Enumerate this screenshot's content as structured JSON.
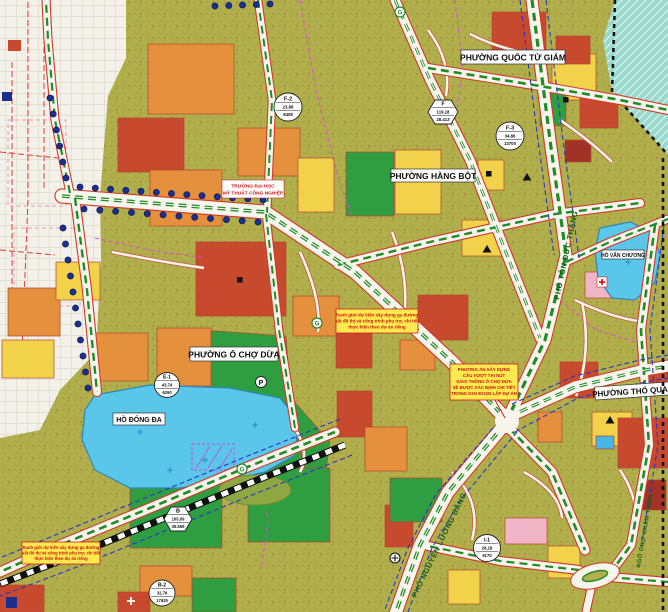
{
  "map": {
    "wards": [
      "PHƯỜNG QUỐC TỬ GIÁM",
      "PHƯỜNG HÀNG BỘT",
      "PHƯỜNG Ô CHỢ DỪA",
      "PHƯỜNG THỔ QUAN"
    ],
    "lakes": [
      "HỒ ĐỐNG ĐA",
      "HỒ VĂN CHƯƠNG"
    ],
    "streets": [
      "PHỐ TÔN ĐỨC THẮNG",
      "PHỐ NGUYỄN LƯƠNG BẰNG",
      "NGÕ CHỢ KHÂM THIÊN"
    ],
    "poi": {
      "university_line1": "TRƯỜNG ĐẠI HỌC",
      "university_line2": "MỸ THUẬT CÔNG NGHIỆP"
    },
    "notes": {
      "metro_station": [
        "Ranh giới dự kiến xây dựng ga đường",
        "sắt đô thị và công trình phụ trợ, chi tiết",
        "thực hiện theo dự án riêng"
      ],
      "overpass": [
        "PHƯƠNG ÁN XÂY DỰNG",
        "CẦU VƯỢT TẠI NÚT",
        "GIAO THÔNG Ô CHỢ DỪA",
        "SẼ ĐƯỢC XÁC ĐỊNH CHI TIẾT",
        "TRONG GIAI ĐOẠN LẬP DỰ ÁN"
      ]
    },
    "parcel_markers": [
      {
        "id": "F-2",
        "area": "23,88",
        "population": "8408"
      },
      {
        "id": "F",
        "area": "119,18",
        "population": "28.413"
      },
      {
        "id": "F-3",
        "area": "34,86",
        "population": "13700"
      },
      {
        "id": "E-1",
        "area": "43,74",
        "population": "6290"
      },
      {
        "id": "B",
        "area": "105,09",
        "population": "35.559"
      },
      {
        "id": "B-2",
        "area": "32,76",
        "population": "17625"
      },
      {
        "id": "I-1",
        "area": "26,18",
        "population": "9170"
      }
    ],
    "symbols": {
      "parking": "P",
      "station": "G"
    },
    "colors": {
      "olive_residential": "#b0af4c",
      "yellow_residential": "#f2d24b",
      "orange_mixed": "#e4903c",
      "red_public": "#c7492e",
      "green_park": "#2e9e41",
      "water": "#5ac6ea",
      "teal_outside_plan": "#9ad9cd",
      "road_median_green": "#1f8c28",
      "road_casing_red": "#cf3a28",
      "tree_dot_navy": "#1b2f8e",
      "boundary_magenta": "#d94fd0"
    }
  }
}
